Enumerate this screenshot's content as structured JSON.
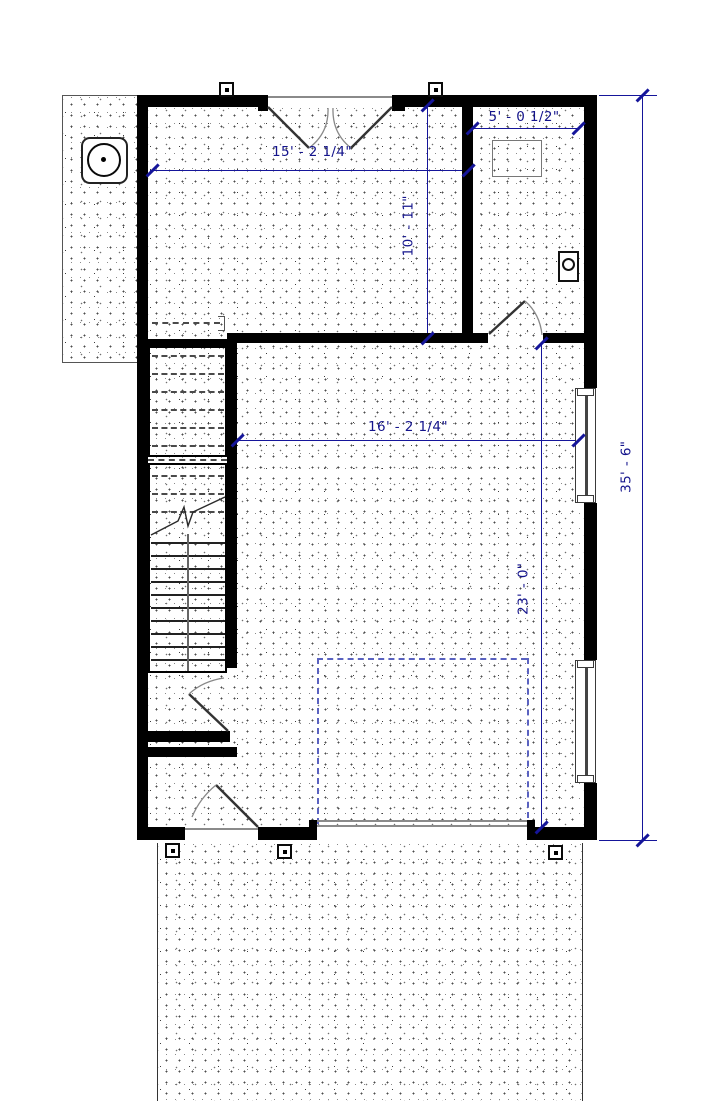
{
  "drawing": {
    "kind": "architectural floor plan",
    "dimensions": {
      "top_main": "15' - 2 1/4\"",
      "top_right": "5' - 0 1/2\"",
      "upper_room_depth": "10' - 11\"",
      "main_width": "16' - 2 1/4\"",
      "lower_depth": "23' - 0\"",
      "overall_depth": "35' - 6\""
    },
    "colors": {
      "wall": "#000000",
      "dimension": "#15159a",
      "hidden_dash": "#4a4a4a",
      "parking_dash": "#5a62c0",
      "threshold": "#8a8a8a"
    }
  }
}
